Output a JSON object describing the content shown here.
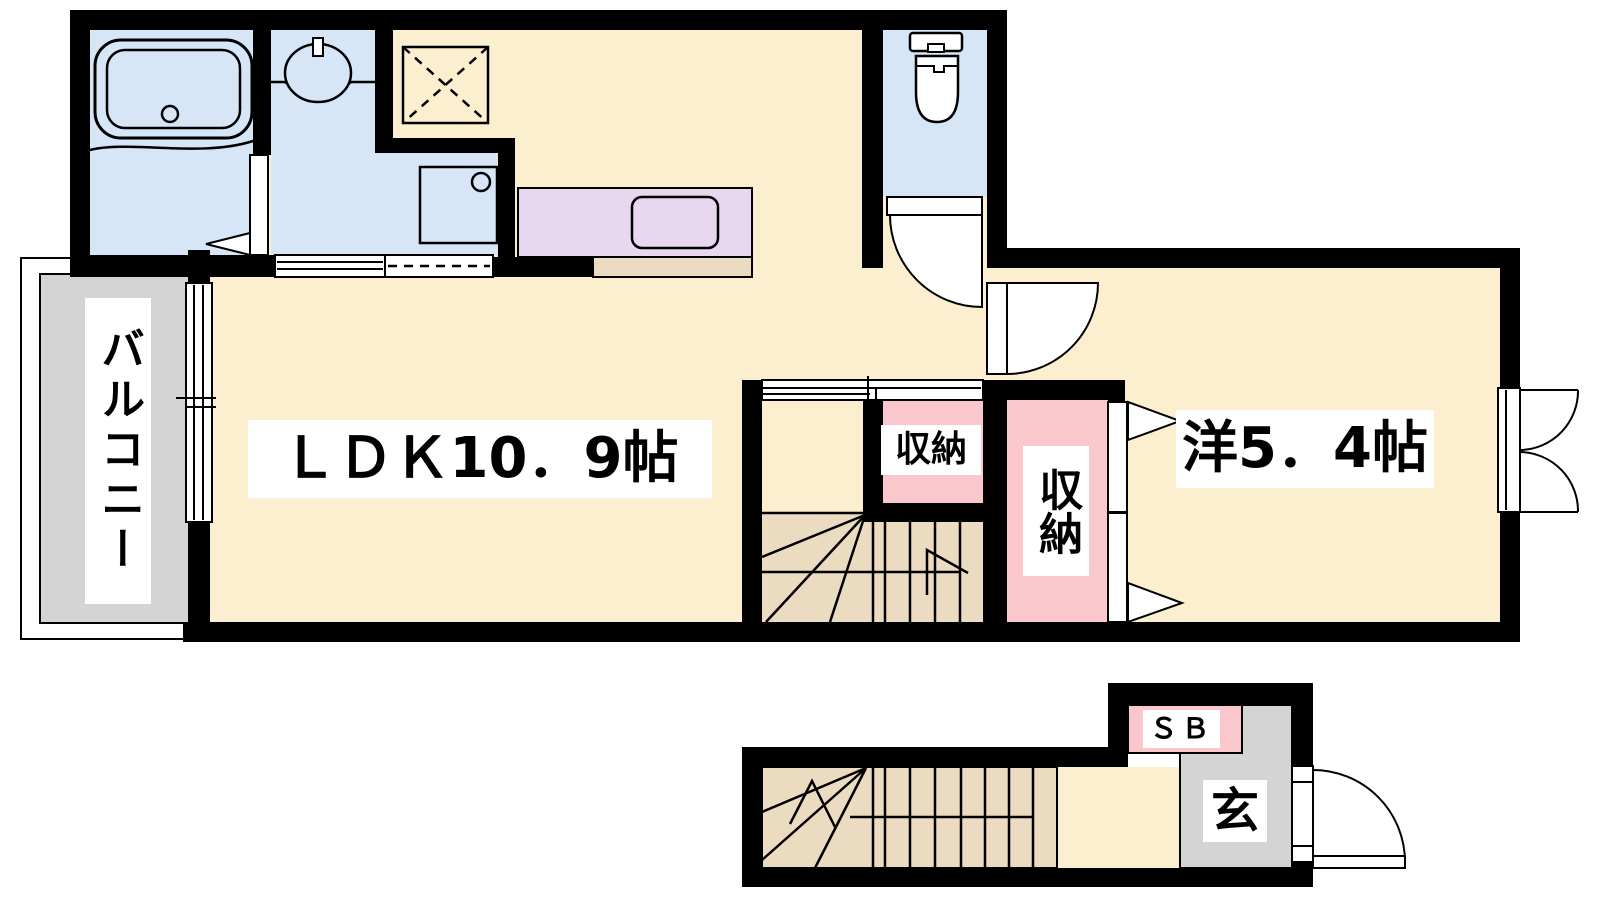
{
  "colors": {
    "wall": "#000000",
    "line": "#000000",
    "floor-cream": "#FBEFD0",
    "wet-blue": "#D7E6F7",
    "closet-pink": "#FAC8CC",
    "stair-tan": "#EBDCC1",
    "counter-purple": "#E7D8F0",
    "balcony-gray": "#D4D4D4",
    "label-bg": "#FFFFFF"
  },
  "labels": {
    "balcony": "バルコニー",
    "ldk": "ＬＤＫ10．9帖",
    "closet_small": "収納",
    "closet_large": "収納",
    "western_room": "洋5．4帖",
    "shoe_box": "ＳＢ",
    "entrance": "玄"
  }
}
